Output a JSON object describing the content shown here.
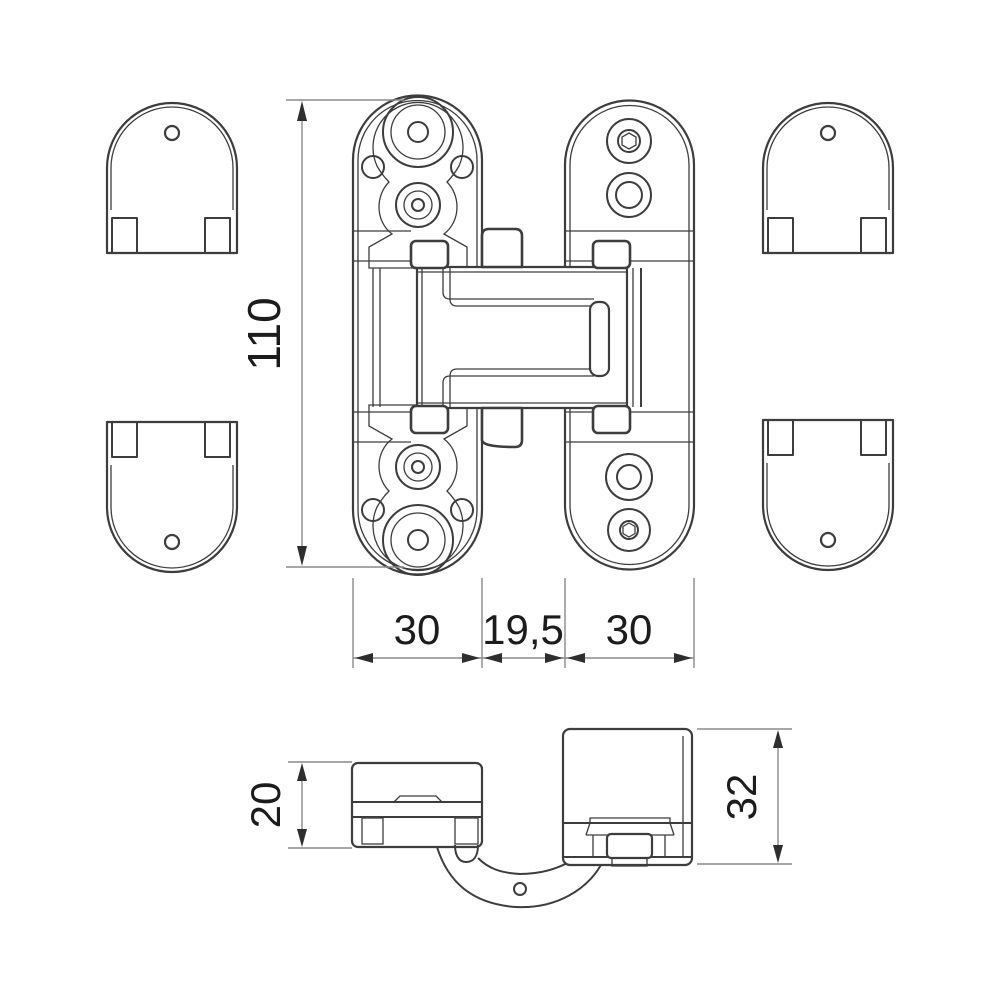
{
  "drawing": {
    "type": "technical dimension drawing of a concealed door hinge",
    "dimensions": {
      "overall_height": "110",
      "door_plate_width": "30",
      "center_gap_width": "19,5",
      "frame_plate_width": "30",
      "door_leaf_depth": "20",
      "frame_side_depth": "32"
    },
    "colors": {
      "background": "#ffffff",
      "line": "#3d3d3d",
      "dimension_line": "#8a8a8a",
      "dimension_text": "#1c1c1c"
    }
  }
}
